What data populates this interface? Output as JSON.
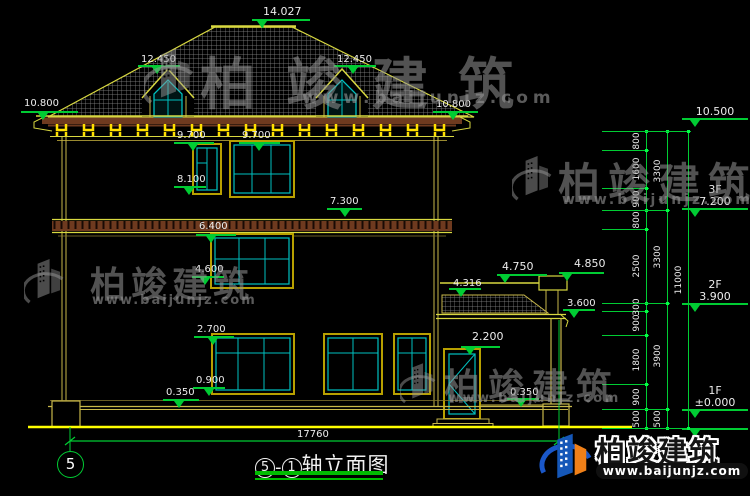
{
  "title": {
    "axis_bubble": "5",
    "axis_start": "5",
    "separator": "-",
    "axis_end": "1",
    "name": "轴立面图"
  },
  "overall_width": "17760",
  "watermark": {
    "brand": "柏竣建筑",
    "url": "www.baijunjz.com"
  },
  "logo": {
    "brand": "柏竣建筑",
    "url": "www.baijunjz.com"
  },
  "elevation_markers": [
    {
      "label": "14.027",
      "tx": 263,
      "ty": 6,
      "lx1": 252,
      "lx2": 310,
      "ly": 19,
      "trix": 257,
      "big": true
    },
    {
      "label": "12.450",
      "tx": 141,
      "ty": 55,
      "lx1": 138,
      "lx2": 180,
      "ly": 65,
      "trix": 152,
      "big": false
    },
    {
      "label": "12.450",
      "tx": 337,
      "ty": 55,
      "lx1": 334,
      "lx2": 376,
      "ly": 65,
      "trix": 348,
      "big": false
    },
    {
      "label": "10.800",
      "tx": 24,
      "ty": 99,
      "lx1": 21,
      "lx2": 78,
      "ly": 111,
      "trix": 38,
      "big": false
    },
    {
      "label": "10.800",
      "tx": 436,
      "ty": 100,
      "lx1": 433,
      "lx2": 478,
      "ly": 111,
      "trix": 448,
      "big": false
    },
    {
      "label": "9.700",
      "tx": 177,
      "ty": 131,
      "lx1": 174,
      "lx2": 214,
      "ly": 142,
      "trix": 188,
      "big": false
    },
    {
      "label": "9.700",
      "tx": 242,
      "ty": 131,
      "lx1": 239,
      "lx2": 280,
      "ly": 142,
      "trix": 254,
      "big": false
    },
    {
      "label": "8.100",
      "tx": 177,
      "ty": 175,
      "lx1": 174,
      "lx2": 206,
      "ly": 186,
      "trix": 184,
      "big": false
    },
    {
      "label": "7.300",
      "tx": 330,
      "ty": 197,
      "lx1": 327,
      "lx2": 362,
      "ly": 208,
      "trix": 340,
      "big": false
    },
    {
      "label": "6.400",
      "tx": 199,
      "ty": 222,
      "lx1": 196,
      "lx2": 236,
      "ly": 234,
      "trix": 206,
      "big": false
    },
    {
      "label": "4.600",
      "tx": 195,
      "ty": 265,
      "lx1": 192,
      "lx2": 224,
      "ly": 276,
      "trix": 200,
      "big": false
    },
    {
      "label": "2.700",
      "tx": 197,
      "ty": 325,
      "lx1": 194,
      "lx2": 234,
      "ly": 336,
      "trix": 208,
      "big": false
    },
    {
      "label": "0.900",
      "tx": 196,
      "ty": 376,
      "lx1": 193,
      "lx2": 225,
      "ly": 387,
      "trix": 204,
      "big": false
    },
    {
      "label": "0.350",
      "tx": 166,
      "ty": 388,
      "lx1": 163,
      "lx2": 199,
      "ly": 399,
      "trix": 174,
      "big": false
    },
    {
      "label": "0.350",
      "tx": 510,
      "ty": 388,
      "lx1": 507,
      "lx2": 539,
      "ly": 398,
      "trix": 516,
      "big": false
    },
    {
      "label": "4.750",
      "tx": 502,
      "ty": 261,
      "lx1": 497,
      "lx2": 547,
      "ly": 274,
      "trix": 500,
      "big": true
    },
    {
      "label": "4.850",
      "tx": 574,
      "ty": 258,
      "lx1": 559,
      "lx2": 604,
      "ly": 272,
      "trix": 562,
      "big": true
    },
    {
      "label": "4.316",
      "tx": 453,
      "ty": 279,
      "lx1": 449,
      "lx2": 481,
      "ly": 288,
      "trix": 456,
      "big": false
    },
    {
      "label": "3.600",
      "tx": 567,
      "ty": 299,
      "lx1": 563,
      "lx2": 595,
      "ly": 309,
      "trix": 569,
      "big": false
    },
    {
      "label": "2.200",
      "tx": 472,
      "ty": 331,
      "lx1": 461,
      "lx2": 500,
      "ly": 346,
      "trix": 465,
      "big": true
    }
  ],
  "right_levels": [
    {
      "floor": "",
      "elev": "10.500",
      "line_y": 118
    },
    {
      "floor": "3F",
      "elev": "7.200",
      "line_y": 208
    },
    {
      "floor": "2F",
      "elev": "3.900",
      "line_y": 303
    },
    {
      "floor": "1F",
      "elev": "±0.000",
      "line_y": 409
    },
    {
      "floor": "",
      "elev": "",
      "line_y": 428
    }
  ],
  "dim_chains": [
    {
      "x": 646,
      "ext_x": 602,
      "boundaries": [
        131,
        150,
        188,
        210,
        229,
        303,
        311,
        335,
        384,
        409,
        428
      ],
      "values": [
        "800",
        "1600",
        "900",
        "800",
        "2500",
        "300",
        "900",
        "1800",
        "900",
        "500"
      ]
    },
    {
      "x": 667,
      "ext_x": 602,
      "boundaries": [
        131,
        210,
        303,
        409,
        428
      ],
      "values": [
        "3300",
        "3300",
        "3900",
        "500"
      ]
    },
    {
      "x": 688,
      "ext_x": 602,
      "boundaries": [
        131,
        428
      ],
      "values": [
        "11000"
      ]
    }
  ],
  "colors": {
    "dim_green": "#00cc33",
    "title_green": "#00bb00",
    "line_yellow": "#d8d840",
    "wall_yellow": "#c8b84a",
    "bright_yellow": "#ffff00",
    "window_teal": "#00c0c0",
    "frame_olive": "#b8a000",
    "band_brown": "#6e3a1f",
    "logo_blue": "#1a57c8",
    "logo_orange": "#f08018"
  }
}
